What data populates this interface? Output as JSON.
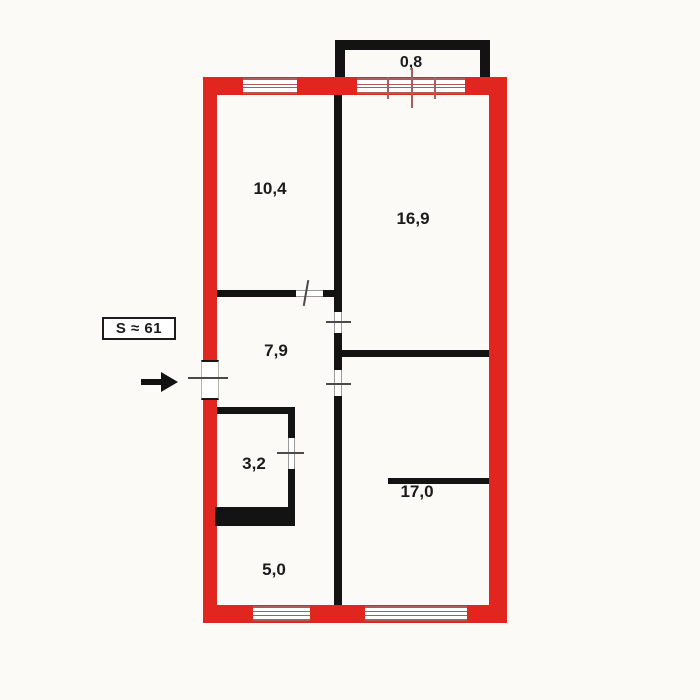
{
  "plan": {
    "total_area_label": "S ≈ 61",
    "rooms": [
      {
        "id": "balcony",
        "area": "0,8"
      },
      {
        "id": "bedroom",
        "area": "10,4"
      },
      {
        "id": "living-room",
        "area": "16,9"
      },
      {
        "id": "hallway",
        "area": "7,9"
      },
      {
        "id": "bathroom",
        "area": "3,2"
      },
      {
        "id": "room-right",
        "area": "17,0"
      },
      {
        "id": "kitchen",
        "area": "5,0"
      }
    ]
  },
  "colors": {
    "outer_wall": "#e1261f",
    "inner_wall": "#131313",
    "window_line": "#a65f5c",
    "background": "#fbfaf7"
  }
}
